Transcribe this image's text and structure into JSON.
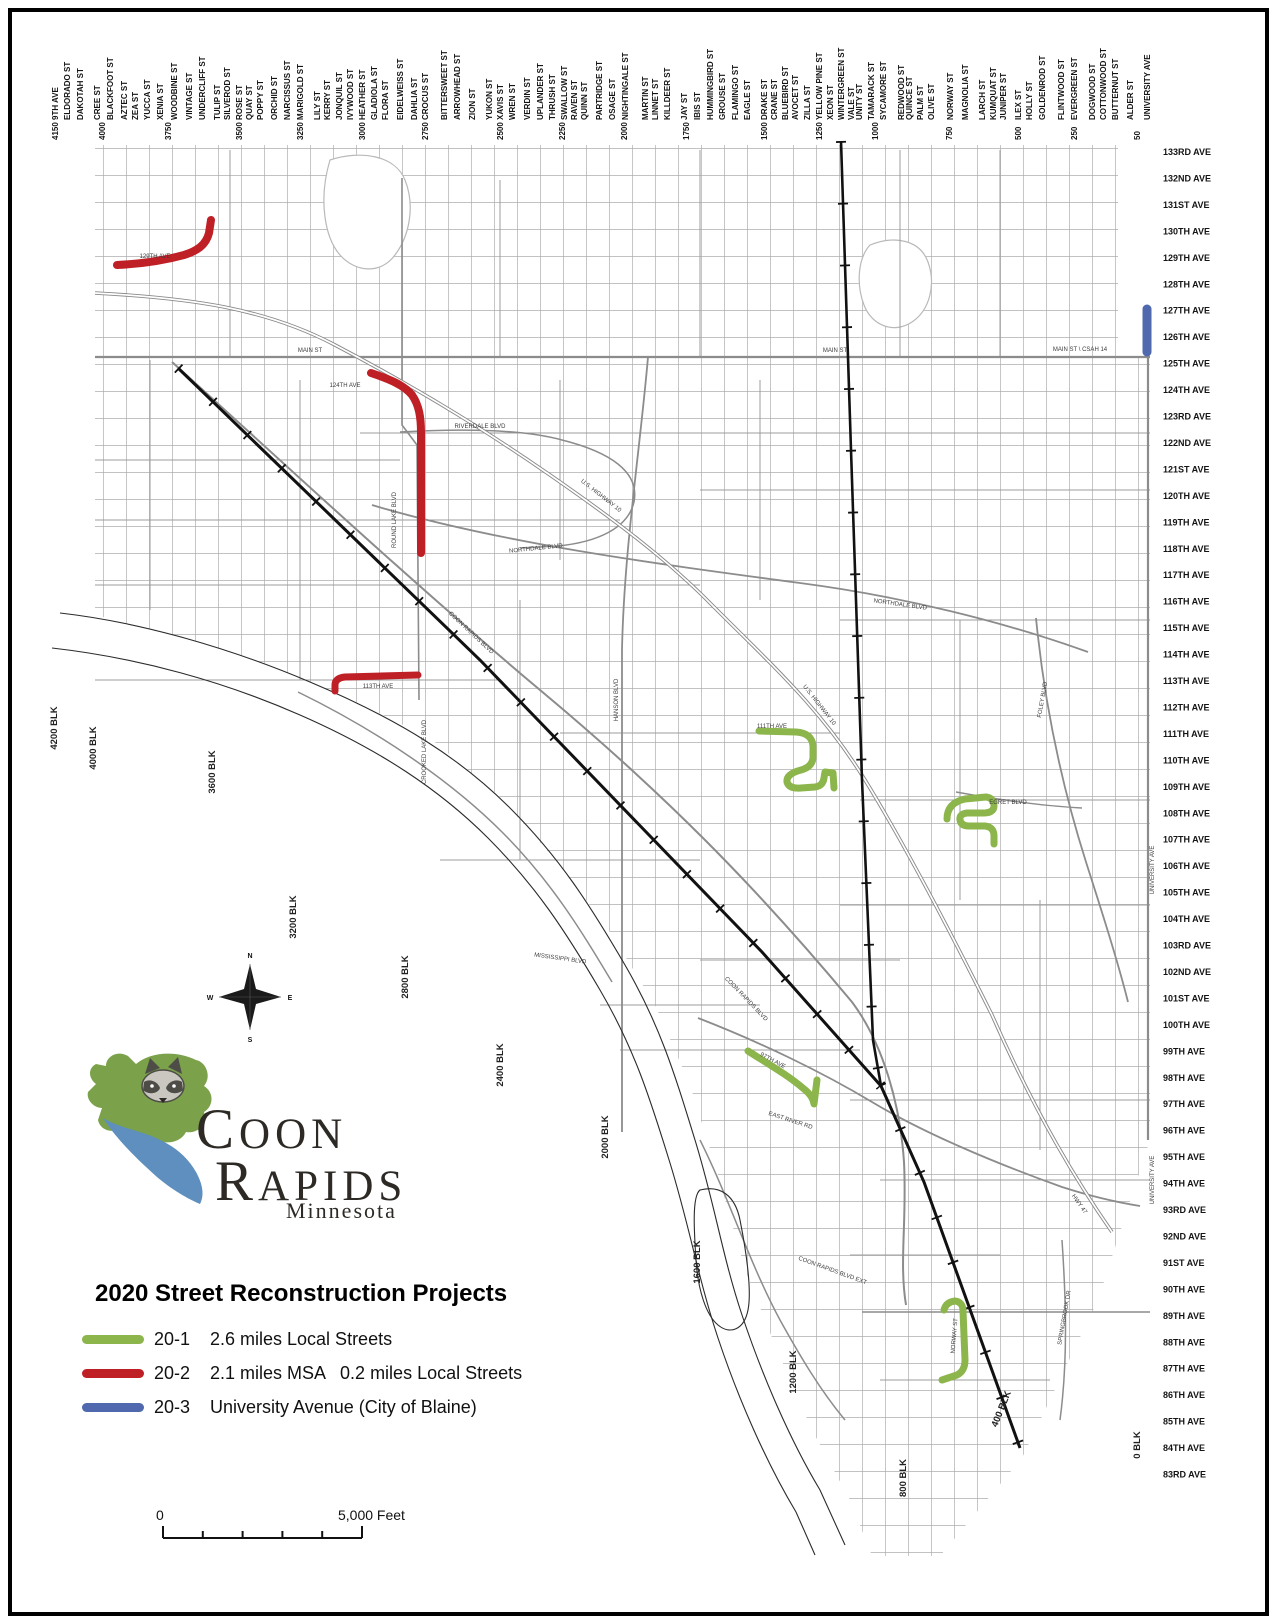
{
  "legend": {
    "title": "2020 Street Reconstruction Projects",
    "items": [
      {
        "id": "20-1",
        "color": "#8cb54c",
        "desc": "2.6 miles Local Streets"
      },
      {
        "id": "20-2",
        "color": "#be2026",
        "desc": "2.1 miles MSA   0.2 miles Local Streets"
      },
      {
        "id": "20-3",
        "color": "#4f68ae",
        "desc": "University Avenue (City of Blaine)"
      }
    ]
  },
  "logo": {
    "line1": "COON",
    "line2": "RAPIDS",
    "state": "Minnesota"
  },
  "scalebar": {
    "left_label": "0",
    "right_label": "5,000 Feet"
  },
  "compass": {
    "points": [
      "N",
      "E",
      "S",
      "W"
    ]
  },
  "map": {
    "top_streets": [
      {
        "l": "9TH AVE",
        "x": 58
      },
      {
        "l": "ELDORADO ST",
        "x": 70
      },
      {
        "l": "DAKOTAH ST",
        "x": 83
      },
      {
        "l": "CREE ST",
        "x": 100
      },
      {
        "l": "BLACKFOOT ST",
        "x": 113
      },
      {
        "l": "AZTEC ST",
        "x": 127
      },
      {
        "l": "ZEA ST",
        "x": 138
      },
      {
        "l": "YUCCA ST",
        "x": 150
      },
      {
        "l": "XENIA ST",
        "x": 163
      },
      {
        "l": "WOODBINE ST",
        "x": 177
      },
      {
        "l": "VINTAGE ST",
        "x": 192
      },
      {
        "l": "UNDERCLIFF ST",
        "x": 205
      },
      {
        "l": "TULIP ST",
        "x": 220
      },
      {
        "l": "SILVEROD ST",
        "x": 230
      },
      {
        "l": "ROSE ST",
        "x": 242
      },
      {
        "l": "QUAY ST",
        "x": 252
      },
      {
        "l": "POPPY ST",
        "x": 263
      },
      {
        "l": "ORCHID ST",
        "x": 277
      },
      {
        "l": "NARCISSUS ST",
        "x": 290
      },
      {
        "l": "MARIGOLD ST",
        "x": 303
      },
      {
        "l": "LILY ST",
        "x": 320
      },
      {
        "l": "KERRY ST",
        "x": 330
      },
      {
        "l": "JONQUIL ST",
        "x": 342
      },
      {
        "l": "IVYWOOD ST",
        "x": 353
      },
      {
        "l": "HEATHER ST",
        "x": 365
      },
      {
        "l": "GLADIOLA ST",
        "x": 377
      },
      {
        "l": "FLORA ST",
        "x": 388
      },
      {
        "l": "EIDELWEISS ST",
        "x": 403
      },
      {
        "l": "DAHLIA ST",
        "x": 417
      },
      {
        "l": "CROCUS ST",
        "x": 428
      },
      {
        "l": "BITTERSWEET ST",
        "x": 447
      },
      {
        "l": "ARROWHEAD ST",
        "x": 460
      },
      {
        "l": "ZION ST",
        "x": 475
      },
      {
        "l": "YUKON ST",
        "x": 492
      },
      {
        "l": "XAVIS ST",
        "x": 503
      },
      {
        "l": "WREN ST",
        "x": 515
      },
      {
        "l": "VERDIN ST",
        "x": 530
      },
      {
        "l": "UPLANDER ST",
        "x": 543
      },
      {
        "l": "THRUSH ST",
        "x": 555
      },
      {
        "l": "SWALLOW ST",
        "x": 567
      },
      {
        "l": "RAVEN ST",
        "x": 577
      },
      {
        "l": "QUINN ST",
        "x": 587
      },
      {
        "l": "PARTRIDGE ST",
        "x": 602
      },
      {
        "l": "OSAGE ST",
        "x": 615
      },
      {
        "l": "NIGHTINGALE ST",
        "x": 628
      },
      {
        "l": "MARTIN ST",
        "x": 648
      },
      {
        "l": "LINNET ST",
        "x": 658
      },
      {
        "l": "KILLDEER ST",
        "x": 670
      },
      {
        "l": "JAY ST",
        "x": 687
      },
      {
        "l": "IBIS ST",
        "x": 700
      },
      {
        "l": "HUMMINGBIRD ST",
        "x": 713
      },
      {
        "l": "GROUSE ST",
        "x": 725
      },
      {
        "l": "FLAMINGO ST",
        "x": 738
      },
      {
        "l": "EAGLE ST",
        "x": 750
      },
      {
        "l": "DRAKE ST",
        "x": 767
      },
      {
        "l": "CRANE ST",
        "x": 777
      },
      {
        "l": "BLUEBIRD ST",
        "x": 788
      },
      {
        "l": "AVOCET ST",
        "x": 798
      },
      {
        "l": "ZILLA ST",
        "x": 810
      },
      {
        "l": "YELLOW PINE ST",
        "x": 822
      },
      {
        "l": "XEON ST",
        "x": 833
      },
      {
        "l": "WINTERGREEN ST",
        "x": 844
      },
      {
        "l": "VALE ST",
        "x": 854
      },
      {
        "l": "UNITY ST",
        "x": 862
      },
      {
        "l": "TAMARACK ST",
        "x": 874
      },
      {
        "l": "SYCAMORE ST",
        "x": 886
      },
      {
        "l": "REDWOOD ST",
        "x": 904
      },
      {
        "l": "QUINCE ST",
        "x": 912
      },
      {
        "l": "PALM ST",
        "x": 923
      },
      {
        "l": "OLIVE ST",
        "x": 934
      },
      {
        "l": "NORWAY ST",
        "x": 953
      },
      {
        "l": "MAGNOLIA ST",
        "x": 968
      },
      {
        "l": "LARCH ST",
        "x": 985
      },
      {
        "l": "KUMQUAT ST",
        "x": 996
      },
      {
        "l": "JUNIPER ST",
        "x": 1006
      },
      {
        "l": "ILEX ST",
        "x": 1021
      },
      {
        "l": "HOLLY ST",
        "x": 1032
      },
      {
        "l": "GOLDENROD ST",
        "x": 1045
      },
      {
        "l": "FLINTWOOD ST",
        "x": 1064
      },
      {
        "l": "EVERGREEN ST",
        "x": 1077
      },
      {
        "l": "DOGWOOD ST",
        "x": 1095
      },
      {
        "l": "COTTONWOOD ST",
        "x": 1106
      },
      {
        "l": "BUTTERNUT ST",
        "x": 1118
      },
      {
        "l": "ALDER ST",
        "x": 1133
      },
      {
        "l": "UNIVERSITY AVE",
        "x": 1150
      }
    ],
    "top_blocks": [
      {
        "l": "4150",
        "x": 58
      },
      {
        "l": "4000",
        "x": 105
      },
      {
        "l": "3750",
        "x": 171
      },
      {
        "l": "3500",
        "x": 242
      },
      {
        "l": "3250",
        "x": 303
      },
      {
        "l": "3000",
        "x": 365
      },
      {
        "l": "2750",
        "x": 428
      },
      {
        "l": "2500",
        "x": 503
      },
      {
        "l": "2250",
        "x": 565
      },
      {
        "l": "2000",
        "x": 627
      },
      {
        "l": "1750",
        "x": 689
      },
      {
        "l": "1500",
        "x": 767
      },
      {
        "l": "1250",
        "x": 822
      },
      {
        "l": "1000",
        "x": 878
      },
      {
        "l": "750",
        "x": 952
      },
      {
        "l": "500",
        "x": 1021
      },
      {
        "l": "250",
        "x": 1077
      },
      {
        "l": "50",
        "x": 1140
      }
    ],
    "right_avenues": [
      "133RD AVE",
      "132ND AVE",
      "131ST AVE",
      "130TH AVE",
      "129TH AVE",
      "128TH AVE",
      "127TH AVE",
      "126TH AVE",
      "125TH AVE",
      "124TH AVE",
      "123RD AVE",
      "122ND AVE",
      "121ST AVE",
      "120TH AVE",
      "119TH AVE",
      "118TH AVE",
      "117TH AVE",
      "116TH AVE",
      "115TH AVE",
      "114TH AVE",
      "113TH AVE",
      "112TH AVE",
      "111TH AVE",
      "110TH AVE",
      "109TH AVE",
      "108TH AVE",
      "107TH AVE",
      "106TH AVE",
      "105TH AVE",
      "104TH AVE",
      "103RD AVE",
      "102ND AVE",
      "101ST AVE",
      "100TH AVE",
      "99TH AVE",
      "98TH AVE",
      "97TH AVE",
      "96TH AVE",
      "95TH AVE",
      "94TH AVE",
      "93RD AVE",
      "92ND AVE",
      "91ST AVE",
      "90TH AVE",
      "89TH AVE",
      "88TH AVE",
      "87TH AVE",
      "86TH AVE",
      "85TH AVE",
      "84TH AVE",
      "83RD AVE"
    ],
    "block_labels": [
      {
        "l": "4200 BLK",
        "x": 57,
        "y": 728
      },
      {
        "l": "4000 BLK",
        "x": 96,
        "y": 748
      },
      {
        "l": "3600 BLK",
        "x": 215,
        "y": 772
      },
      {
        "l": "3200 BLK",
        "x": 296,
        "y": 917
      },
      {
        "l": "2800 BLK",
        "x": 408,
        "y": 977
      },
      {
        "l": "2400 BLK",
        "x": 503,
        "y": 1065
      },
      {
        "l": "2000 BLK",
        "x": 608,
        "y": 1137
      },
      {
        "l": "1600 BLK",
        "x": 700,
        "y": 1262
      },
      {
        "l": "1200 BLK",
        "x": 796,
        "y": 1372
      },
      {
        "l": "800 BLK",
        "x": 906,
        "y": 1478
      },
      {
        "l": "400 BLK",
        "x": 1004,
        "y": 1410,
        "r": -68
      },
      {
        "l": "0 BLK",
        "x": 1140,
        "y": 1445
      }
    ],
    "road_labels": [
      {
        "t": "MAIN ST",
        "x": 310,
        "y": 352
      },
      {
        "t": "MAIN ST",
        "x": 835,
        "y": 352
      },
      {
        "t": "MAIN ST \\ CSAH 14",
        "x": 1080,
        "y": 351
      },
      {
        "t": "U.S. HIGHWAY 10",
        "x": 600,
        "y": 497,
        "r": 38
      },
      {
        "t": "U.S. HIGHWAY 10",
        "x": 818,
        "y": 706,
        "r": 52
      },
      {
        "t": "NORTHDALE BLVD",
        "x": 536,
        "y": 550,
        "r": -6
      },
      {
        "t": "NORTHDALE BLVD",
        "x": 900,
        "y": 606,
        "r": 8
      },
      {
        "t": "COON RAPIDS BLVD",
        "x": 470,
        "y": 634,
        "r": 43
      },
      {
        "t": "COON RAPIDS BLVD",
        "x": 745,
        "y": 1000,
        "r": 46
      },
      {
        "t": "ROUND LAKE BLVD",
        "x": 396,
        "y": 520,
        "r": -90
      },
      {
        "t": "CROOKED LAKE BLVD",
        "x": 426,
        "y": 752,
        "r": -90
      },
      {
        "t": "HANSON BLVD",
        "x": 618,
        "y": 700,
        "r": -90
      },
      {
        "t": "RIVERDALE BLVD",
        "x": 480,
        "y": 428
      },
      {
        "t": "MISSISSIPPI BLVD",
        "x": 560,
        "y": 960,
        "r": 8
      },
      {
        "t": "EAST RIVER RD",
        "x": 790,
        "y": 1122,
        "r": 18
      },
      {
        "t": "FOLEY BLVD",
        "x": 1044,
        "y": 700,
        "r": -80
      },
      {
        "t": "UNIVERSITY AVE",
        "x": 1154,
        "y": 870,
        "r": -90
      },
      {
        "t": "UNIVERSITY AVE",
        "x": 1154,
        "y": 1180,
        "r": -90
      },
      {
        "t": "EGRET BLVD",
        "x": 1008,
        "y": 804
      },
      {
        "t": "SPRINGBROOK DR",
        "x": 1066,
        "y": 1318,
        "r": -80
      },
      {
        "t": "HWY 47",
        "x": 1078,
        "y": 1205,
        "r": 55
      },
      {
        "t": "COON RAPIDS BLVD EXT",
        "x": 832,
        "y": 1272,
        "r": 20
      },
      {
        "t": "124TH AVE",
        "x": 345,
        "y": 387
      },
      {
        "t": "113TH AVE",
        "x": 378,
        "y": 688
      },
      {
        "t": "111TH AVE",
        "x": 772,
        "y": 728
      },
      {
        "t": "97TH AVE",
        "x": 772,
        "y": 1062,
        "r": 28
      },
      {
        "t": "NORWAY ST",
        "x": 956,
        "y": 1336,
        "r": -85
      },
      {
        "t": "129TH AVE",
        "x": 155,
        "y": 258
      }
    ],
    "projects": [
      {
        "project": "20-2",
        "color": "#be2026",
        "width": 8,
        "path": "M211,220 L209,233 C206,245 197,251 184,255 C162,261 138,264 117,265"
      },
      {
        "project": "20-2",
        "color": "#be2026",
        "width": 8,
        "path": "M371,373 C389,379 404,385 412,395 C419,405 421,417 421,433 L421,553"
      },
      {
        "project": "20-2",
        "color": "#be2026",
        "width": 7,
        "path": "M335,691 L335,685 Q335,678 345,677 L418,675"
      },
      {
        "project": "20-1",
        "color": "#8cb54c",
        "width": 7,
        "path": "M759,731 L796,732 Q812,733 813,746 L813,758 Q812,767 801,770 Q786,774 787,782 Q789,789 801,788 L815,787 Q823,786 824,778 L825,772 L833,773 L834,788"
      },
      {
        "project": "20-1",
        "color": "#8cb54c",
        "width": 7,
        "path": "M947,819 Q947,803 965,799 L986,797 Q994,798 994,806 Q994,813 983,813 L967,813 Q959,814 960,820 Q961,826 969,826 L985,826 Q994,827 994,836 L994,844"
      },
      {
        "project": "20-1",
        "color": "#8cb54c",
        "width": 7,
        "path": "M748,1051 C765,1062 788,1075 804,1089 Q813,1096 814,1104 L817,1080"
      },
      {
        "project": "20-1",
        "color": "#8cb54c",
        "width": 7,
        "path": "M944,1310 Q946,1302 955,1301 Q963,1302 963,1311 L965,1360 Q965,1371 957,1375 L942,1380"
      },
      {
        "project": "20-3",
        "color": "#4f68ae",
        "width": 9,
        "path": "M1147,309 L1147,352"
      }
    ]
  }
}
